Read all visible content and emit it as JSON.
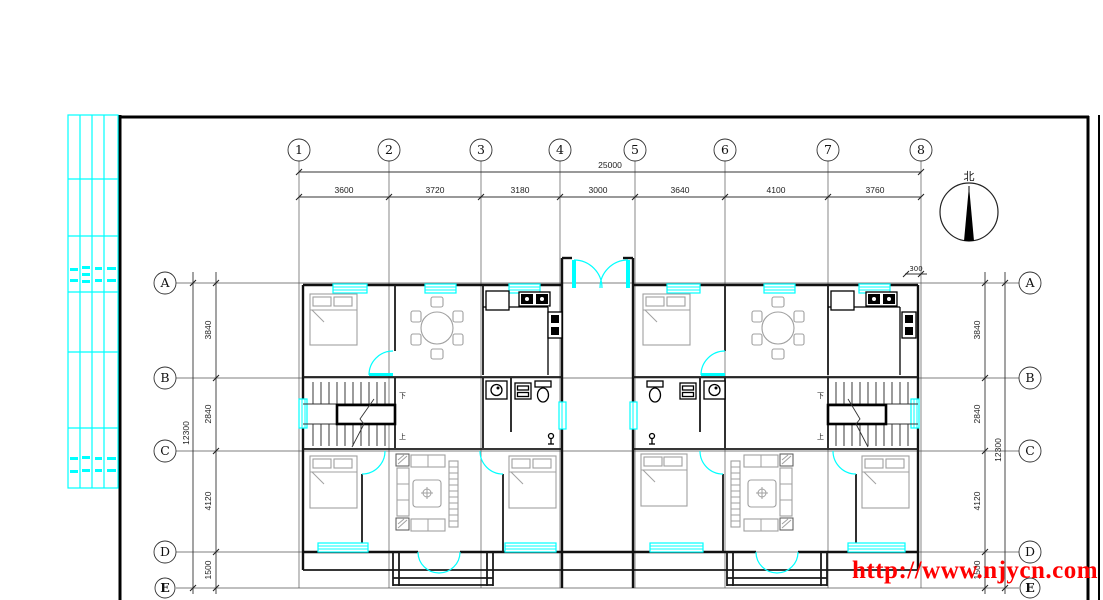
{
  "colors": {
    "accent_cyan": "#00ffff",
    "line_black": "#000000",
    "furniture_gray": "#a0a0a0",
    "watermark_red": "#ff0000"
  },
  "grid": {
    "columns": [
      "1",
      "2",
      "3",
      "4",
      "5",
      "6",
      "7",
      "8"
    ],
    "rows": [
      "A",
      "B",
      "C",
      "D",
      "E"
    ]
  },
  "dimensions": {
    "total_width": "25000",
    "width_segments": [
      "3600",
      "3720",
      "3180",
      "3000",
      "3640",
      "4100",
      "3760"
    ],
    "total_height": "12300",
    "height_segments": [
      "3840",
      "2840",
      "4120",
      "1500"
    ],
    "entry_step": "300"
  },
  "compass": {
    "north_label": "北"
  },
  "stairs": {
    "down_label": "下",
    "up_label": "上"
  },
  "watermark": {
    "url_text": "http://www.njycn.com"
  }
}
